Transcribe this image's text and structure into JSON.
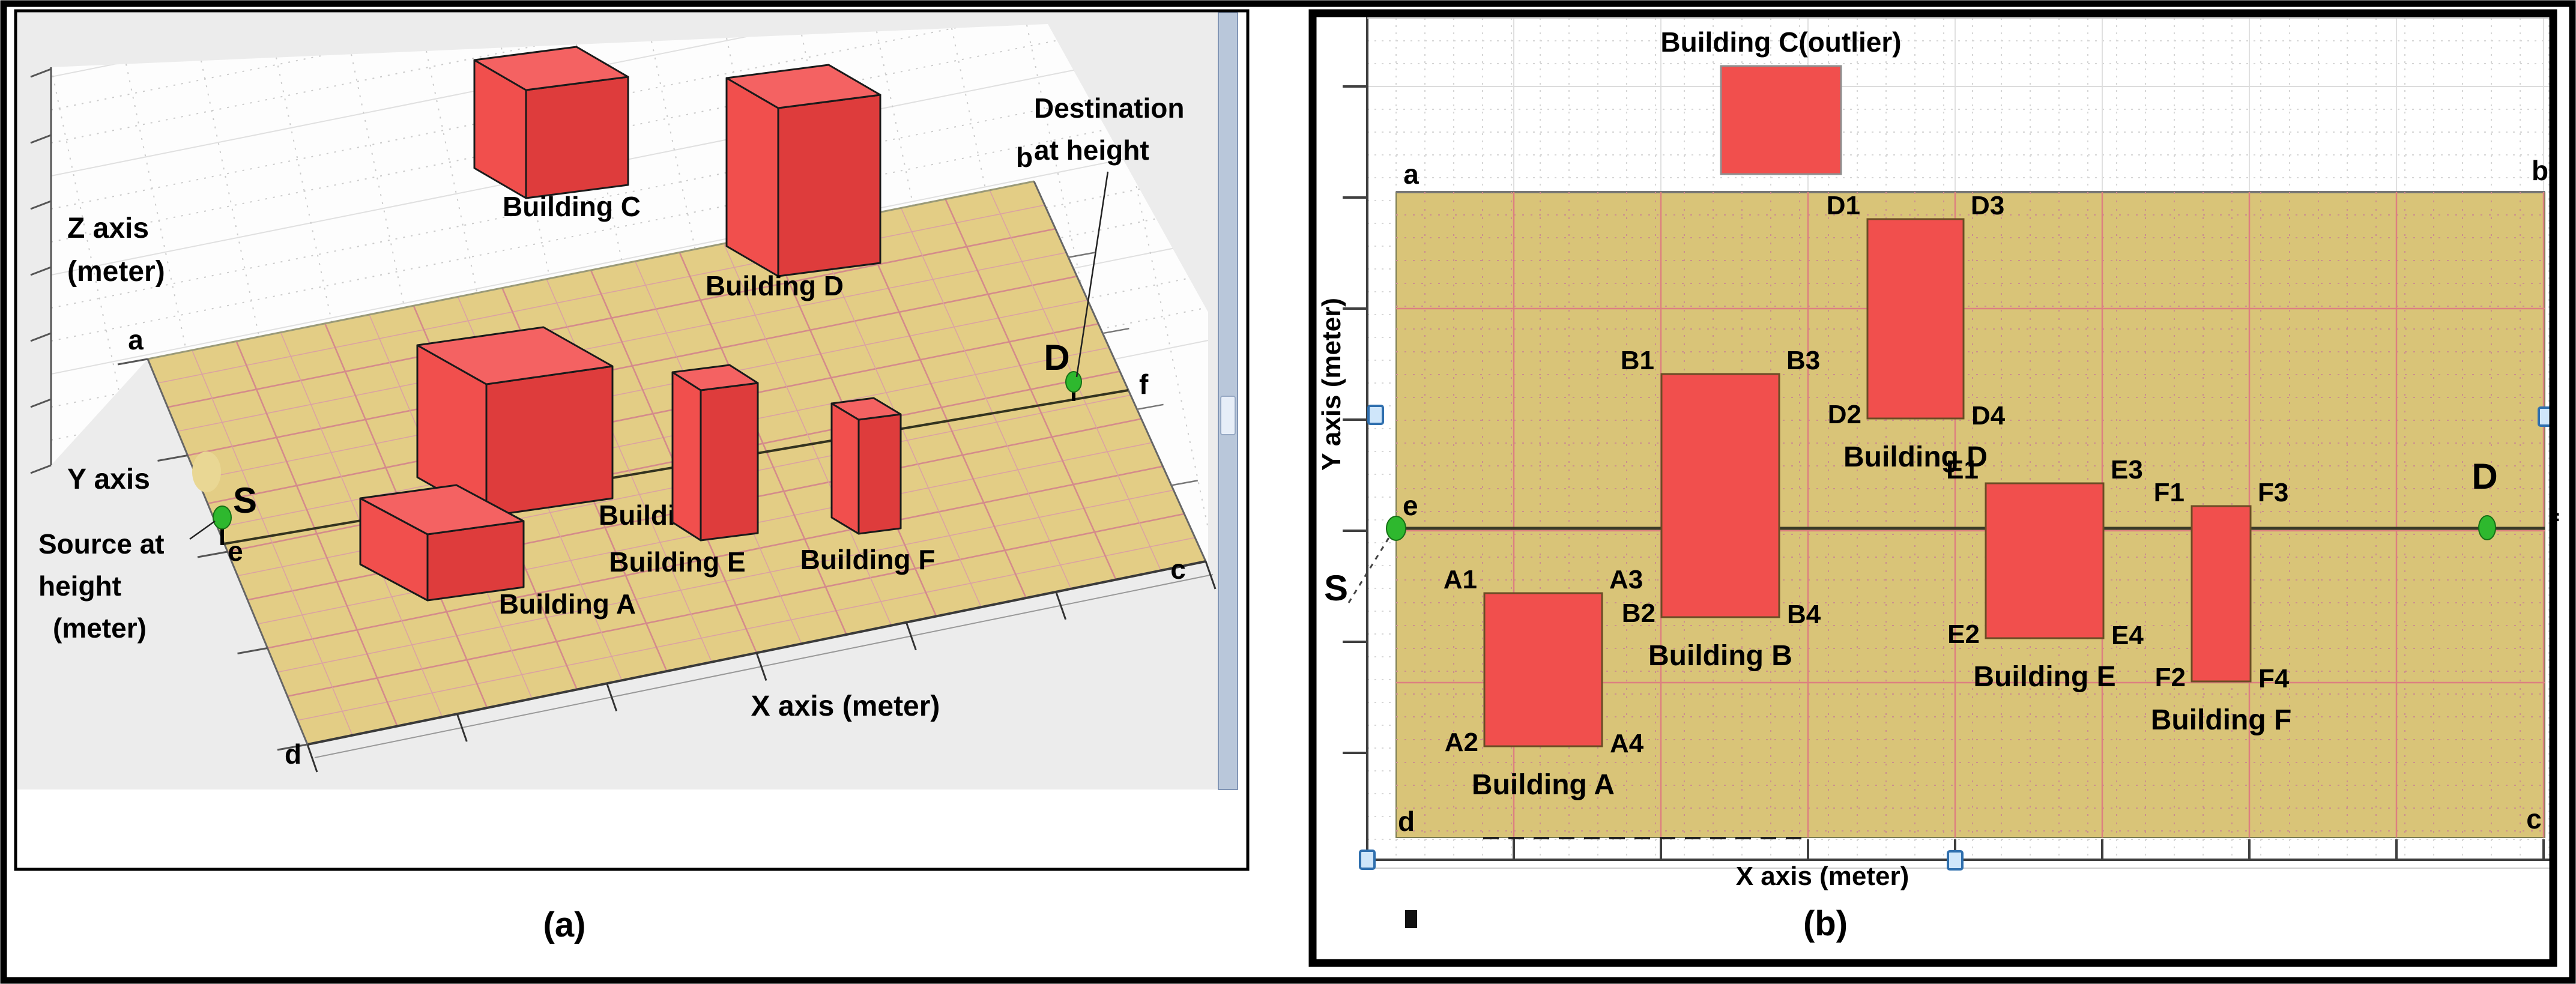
{
  "figure": {
    "colors": {
      "building_red": "#f14f4d",
      "building_red_side": "#de3c3c",
      "building_red_top": "#f46262",
      "ground_tan_3d": "#e3cd85",
      "ground_tan_2d": "#d9c478",
      "grid_pink": "#cc8f8f",
      "marker_green": "#2eb82e",
      "handle_blue": "#2f6fae",
      "axis_gray": "#3f3f3f"
    },
    "panel_a": {
      "caption": "(a)",
      "z_axis_label": [
        "Z axis",
        "(meter)"
      ],
      "y_axis_label": "Y axis",
      "x_axis_label": "X axis  (meter)",
      "source_annotation": [
        "Source at",
        "height",
        "(meter)"
      ],
      "destination_annotation": [
        "Destination",
        "at height"
      ],
      "source_marker": "S",
      "destination_marker": "D",
      "corner_labels": {
        "a": "a",
        "b": "b",
        "c": "c",
        "d": "d",
        "e": "e",
        "f": "f"
      },
      "buildings": [
        {
          "name": "Building A"
        },
        {
          "name": "Building B"
        },
        {
          "name": "Building C"
        },
        {
          "name": "Building D"
        },
        {
          "name": "Building E"
        },
        {
          "name": "Building F"
        }
      ]
    },
    "panel_b": {
      "caption": "(b)",
      "y_axis_label": "Y axis  (meter)",
      "x_axis_label": "X axis  (meter)",
      "outlier_building": {
        "name": "Building C(outlier)"
      },
      "source_marker": "S",
      "destination_marker": "D",
      "corner_labels": {
        "a": "a",
        "b": "b",
        "c": "c",
        "d": "d",
        "e": "e",
        "f": "f"
      },
      "buildings": [
        {
          "name": "Building A",
          "corner_labels": {
            "tl": "A1",
            "tr": "A3",
            "bl": "A2",
            "br": "A4"
          }
        },
        {
          "name": "Building B",
          "corner_labels": {
            "tl": "B1",
            "tr": "B3",
            "bl": "B2",
            "br": "B4"
          }
        },
        {
          "name": "Building D",
          "corner_labels": {
            "tl": "D1",
            "tr": "D3",
            "bl": "D2",
            "br": "D4"
          }
        },
        {
          "name": "Building E",
          "corner_labels": {
            "tl": "E1",
            "tr": "E3",
            "bl": "E2",
            "br": "E4"
          }
        },
        {
          "name": "Building F",
          "corner_labels": {
            "tl": "F1",
            "tr": "F3",
            "bl": "F2",
            "br": "F4"
          }
        }
      ]
    }
  }
}
